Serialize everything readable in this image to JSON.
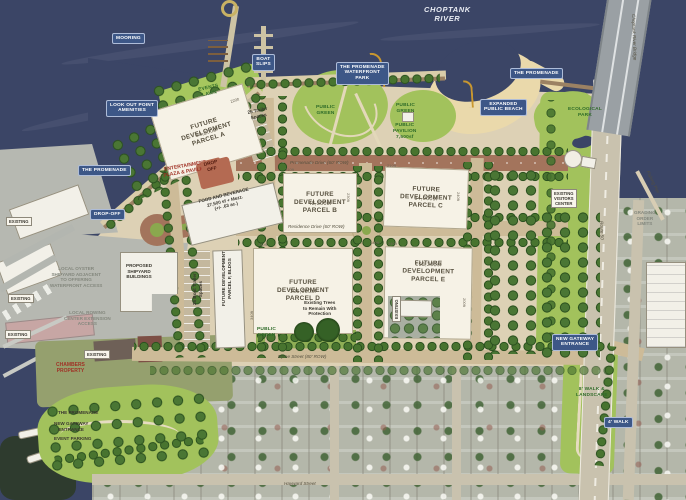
{
  "map": {
    "title": "Waterfront development master plan",
    "colors": {
      "water": "#3b4566",
      "sand": "#ead9ab",
      "lawn": "#a2c25c",
      "parcel": "#f6f2e6",
      "road_brown": "#a3745c",
      "road_tan": "#cdbb98",
      "tag_blue": "#3d5787",
      "red_text": "#a03226",
      "green_text": "#2e6b28",
      "tree": "#48742f"
    },
    "parcels": [
      {
        "name": "FUTURE\nDEVELOPMENT\nPARCEL A",
        "area": "50,200sf"
      },
      {
        "name": "FUTURE\nDEVELOPMENT\nPARCEL B",
        "area": "48,300sf"
      },
      {
        "name": "FUTURE\nDEVELOPMENT\nPARCEL C",
        "area": "54,000sf"
      },
      {
        "name": "FUTURE\nDEVELOPMENT\nPARCEL D",
        "area": "105,000sf"
      },
      {
        "name": "FUTURE\nDEVELOPMENT\nPARCEL E",
        "area": "103,200sf"
      }
    ],
    "labels": [
      {
        "name": "river-label",
        "style": "river",
        "x": 424,
        "y": 5,
        "text": "CHOPTANK\nRIVER"
      },
      {
        "name": "mooring-tag",
        "style": "tag",
        "x": 112,
        "y": 33,
        "text": "MOORING"
      },
      {
        "name": "lookout-point-tag",
        "style": "tag",
        "x": 106,
        "y": 100,
        "text": "LOOK OUT POINT\nAMENITIES"
      },
      {
        "name": "boat-slips-tag",
        "style": "tag",
        "x": 252,
        "y": 54,
        "text": "BOAT\nSLIPS"
      },
      {
        "name": "promenade-waterfront-park-tag",
        "style": "tag",
        "x": 336,
        "y": 62,
        "text": "THE PROMENADE\nWATERFRONT\nPARK"
      },
      {
        "name": "promenade-right-tag",
        "style": "tag",
        "x": 510,
        "y": 68,
        "text": "THE PROMENADE"
      },
      {
        "name": "expanded-beach-tag",
        "style": "tag",
        "x": 480,
        "y": 99,
        "text": "EXPANDED\nPUBLIC BEACH"
      },
      {
        "name": "promenade-left-tag",
        "style": "tag",
        "x": 78,
        "y": 165,
        "text": "THE PROMENADE"
      },
      {
        "name": "drop-off-tag",
        "style": "tag",
        "x": 90,
        "y": 209,
        "text": "DROP-OFF"
      },
      {
        "name": "new-gateway-tag",
        "style": "tag",
        "x": 552,
        "y": 334,
        "text": "NEW GATEWAY\nENTRANCE"
      },
      {
        "name": "walk-tag",
        "style": "tag",
        "x": 604,
        "y": 417,
        "text": "4' WALK"
      },
      {
        "name": "events-lawn-label",
        "style": "green",
        "x": 198,
        "y": 88,
        "rot": -12,
        "text": "EVENTS\nLAWN"
      },
      {
        "name": "public-green-west-label",
        "style": "green",
        "x": 316,
        "y": 105,
        "text": "PUBLIC\nGREEN"
      },
      {
        "name": "public-green-east-label",
        "style": "green",
        "x": 396,
        "y": 103,
        "text": "PUBLIC\nGREEN"
      },
      {
        "name": "public-pavilion-label",
        "style": "green",
        "x": 393,
        "y": 123,
        "text": "PUBLIC\nPAVILION\n7,500sf"
      },
      {
        "name": "public-green-south-label",
        "style": "green",
        "x": 257,
        "y": 327,
        "text": "PUBLIC\nGREEN"
      },
      {
        "name": "ecological-park-label",
        "style": "green",
        "x": 568,
        "y": 107,
        "text": "ECOLOGICAL\nPARK"
      },
      {
        "name": "walk-landscape-label",
        "style": "green",
        "x": 576,
        "y": 387,
        "text": "8' WALK &\nLANDSCAPE"
      },
      {
        "name": "entertainment-plaza-label",
        "style": "red",
        "x": 162,
        "y": 167,
        "rot": -10,
        "text": "ENTERTAINMENT\nPLAZA & PAVILION"
      },
      {
        "name": "chambers-property-label",
        "style": "red",
        "x": 56,
        "y": 362,
        "text": "CHAMBERS\nPROPERTY"
      },
      {
        "name": "drop-off-box-label",
        "style": "dropoff",
        "x": 200,
        "y": 162,
        "rot": -14,
        "text": "DROP\nOFF"
      },
      {
        "name": "food-beverage-label",
        "style": "dark",
        "x": 198,
        "y": 199,
        "rot": -14,
        "text": "FOOD AND BEVERAGE\n27,500 sf + Mezz.\n(+/- .63 ac.)"
      },
      {
        "name": "proposed-shipyard-label",
        "style": "dark",
        "x": 126,
        "y": 263,
        "text": "PROPOSED\nSHIPYARD\nBUILDINGS"
      },
      {
        "name": "visitors-center-label",
        "style": "wbox",
        "x": 551,
        "y": 189,
        "text": "EXISTING\nVISITORS\nCENTER"
      },
      {
        "name": "existing-label-1",
        "style": "wbox",
        "x": 6,
        "y": 217,
        "text": "EXISTING"
      },
      {
        "name": "existing-label-2",
        "style": "wbox",
        "x": 8,
        "y": 294,
        "text": "EXISTING"
      },
      {
        "name": "existing-label-3",
        "style": "wbox",
        "x": 5,
        "y": 330,
        "text": "EXISTING"
      },
      {
        "name": "existing-label-4",
        "style": "wbox",
        "x": 84,
        "y": 350,
        "text": "EXISTING"
      },
      {
        "name": "existing-parcel-e-label",
        "style": "wbox",
        "x": 392,
        "y": 322,
        "rot": -90,
        "text": "EXISTING"
      },
      {
        "name": "trailer-spaces-label",
        "style": "dark",
        "x": 247,
        "y": 110,
        "rot": -12,
        "text": "25 Trailer\nSpaces"
      },
      {
        "name": "existing-trees-label",
        "style": "dark",
        "x": 303,
        "y": 300,
        "text": "Existing Trees\nto Remain With\nProtection"
      },
      {
        "name": "promenade-south-label",
        "style": "dark",
        "x": 58,
        "y": 410,
        "text": "THE PROMENADE"
      },
      {
        "name": "gateway-south-label",
        "style": "dark",
        "x": 54,
        "y": 421,
        "text": "NEW GATEWAY\nENTRANCE"
      },
      {
        "name": "event-parking-label",
        "style": "dark",
        "x": 54,
        "y": 436,
        "text": "EVENT PARKING"
      },
      {
        "name": "boat-trailer-label",
        "style": "dark",
        "x": 192,
        "y": 305,
        "rot": -90,
        "text": "25 Boat Trailer\nSpaces"
      },
      {
        "name": "parcel-f-label",
        "style": "dark",
        "x": 221,
        "y": 306,
        "rot": -90,
        "text": "FUTURE DEVELOPMENT\nPARCEL F, BLDGS"
      },
      {
        "name": "oyster-shipyard-note",
        "style": "gray",
        "x": 50,
        "y": 266,
        "text": "LOCAL OYSTER\nSHIPYARD ADJACENT\nTO OFFERING\nWATERFRONT ACCESS"
      },
      {
        "name": "rowing-center-note",
        "style": "gray",
        "x": 64,
        "y": 310,
        "text": "LOCAL ROWING\nCENTER EXTENSION\nACCESS"
      },
      {
        "name": "order-limits-note",
        "style": "gray",
        "x": 634,
        "y": 210,
        "text": "GRADING\nORDER\nLIMITS"
      },
      {
        "name": "promenade-drive-label",
        "style": "street",
        "x": 290,
        "y": 160,
        "text": "Promenade Drive (60' ROW)"
      },
      {
        "name": "residence-drive-label",
        "style": "street",
        "x": 288,
        "y": 224,
        "text": "Residence Drive (60' ROW)"
      },
      {
        "name": "byrne-street-label",
        "style": "street",
        "x": 278,
        "y": 354,
        "text": "Byrne Street (80' ROW)"
      },
      {
        "name": "route-50-label",
        "style": "street",
        "x": 604,
        "y": 221,
        "rot": 88,
        "text": "Route 50"
      },
      {
        "name": "fishing-pier-label",
        "style": "street",
        "x": 650,
        "y": 170,
        "rot": 64,
        "text": "Fishing Pier"
      },
      {
        "name": "bridge-label",
        "style": "street",
        "x": 636,
        "y": 14,
        "rot": 88,
        "text": "Choptank River Bridge"
      },
      {
        "name": "hayward-street-label",
        "style": "street",
        "x": 284,
        "y": 481,
        "text": "Hayward Street"
      },
      {
        "name": "dim-parcel-a",
        "style": "dim",
        "x": 230,
        "y": 100,
        "rot": -16,
        "text": "220ft"
      },
      {
        "name": "dim-parcel-b-top",
        "style": "dim",
        "x": 285,
        "y": 168,
        "text": "210ft"
      },
      {
        "name": "dim-parcel-b-right",
        "style": "dim",
        "x": 350,
        "y": 193,
        "rot": 90,
        "text": "230ft"
      },
      {
        "name": "dim-parcel-c-top",
        "style": "dim",
        "x": 387,
        "y": 164,
        "text": "210ft"
      },
      {
        "name": "dim-parcel-c-right",
        "style": "dim",
        "x": 460,
        "y": 192,
        "rot": 90,
        "text": "240ft"
      },
      {
        "name": "dim-parcel-d-top",
        "style": "dim",
        "x": 258,
        "y": 243,
        "text": "340ft"
      },
      {
        "name": "dim-parcel-d-left",
        "style": "dim",
        "x": 250,
        "y": 320,
        "rot": -90,
        "text": "340ft"
      },
      {
        "name": "dim-parcel-e-top",
        "style": "dim",
        "x": 388,
        "y": 242,
        "text": "340ft"
      },
      {
        "name": "dim-parcel-e-right",
        "style": "dim",
        "x": 466,
        "y": 298,
        "rot": 90,
        "text": "200ft"
      },
      {
        "name": "dim-140",
        "style": "dim",
        "x": 370,
        "y": 241,
        "text": "140ft"
      }
    ]
  }
}
